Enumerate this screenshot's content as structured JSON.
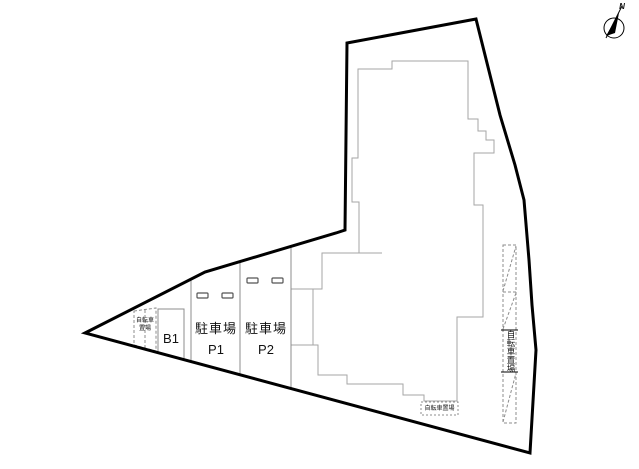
{
  "diagram": {
    "type": "site-plan",
    "background": "#ffffff",
    "colors": {
      "boundary": "#000000",
      "building_line": "#a6a6a6",
      "divider_line": "#8c8c8c",
      "dashed_line": "#8c8c8c",
      "stopper_line": "#555555",
      "text": "#111111"
    },
    "north": {
      "label": "N"
    },
    "labels": {
      "parking_p1": {
        "title": "駐車場",
        "code": "P1"
      },
      "parking_p2": {
        "title": "駐車場",
        "code": "P2"
      },
      "basement": {
        "code": "B1"
      },
      "bicycle_left": {
        "line1": "自転車",
        "line2": "置場"
      },
      "bicycle_right": {
        "text": "自転車置場"
      },
      "bicycle_bottom": {
        "text": "自転車置場"
      }
    }
  }
}
